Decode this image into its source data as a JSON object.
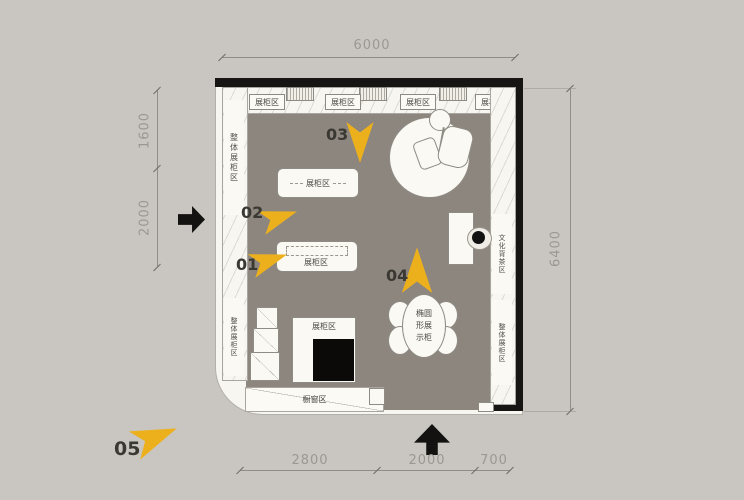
{
  "plan": {
    "dimensions": {
      "top": "6000",
      "left": [
        "1600",
        "2000"
      ],
      "right": "6400",
      "bottom": [
        "2800",
        "2000",
        "700"
      ]
    },
    "walls": {
      "top_sections": [
        "展柜区",
        "展柜区",
        "展柜区",
        "展柜区"
      ],
      "left_upper": "整体展柜区",
      "left_lower": "整体展柜区",
      "right_middle": "文化背茶区",
      "right_lower": "整体展柜区",
      "window": "橱窗区"
    },
    "furniture": {
      "table_a": "展柜区",
      "table_b": "展柜区",
      "square_display": "展柜区",
      "oval_display_lines": [
        "椭圆",
        "形展",
        "示柜"
      ]
    },
    "markers": [
      "01",
      "02",
      "03",
      "04",
      "05"
    ],
    "colors": {
      "background": "#c9c6c1",
      "floor": "#8d867e",
      "wall": "#161513",
      "cabinet_fill": "#f8f6f0",
      "marker_arrow": "#edb01d",
      "dimension_text": "#9b9892",
      "label_text": "#4a4842"
    }
  }
}
